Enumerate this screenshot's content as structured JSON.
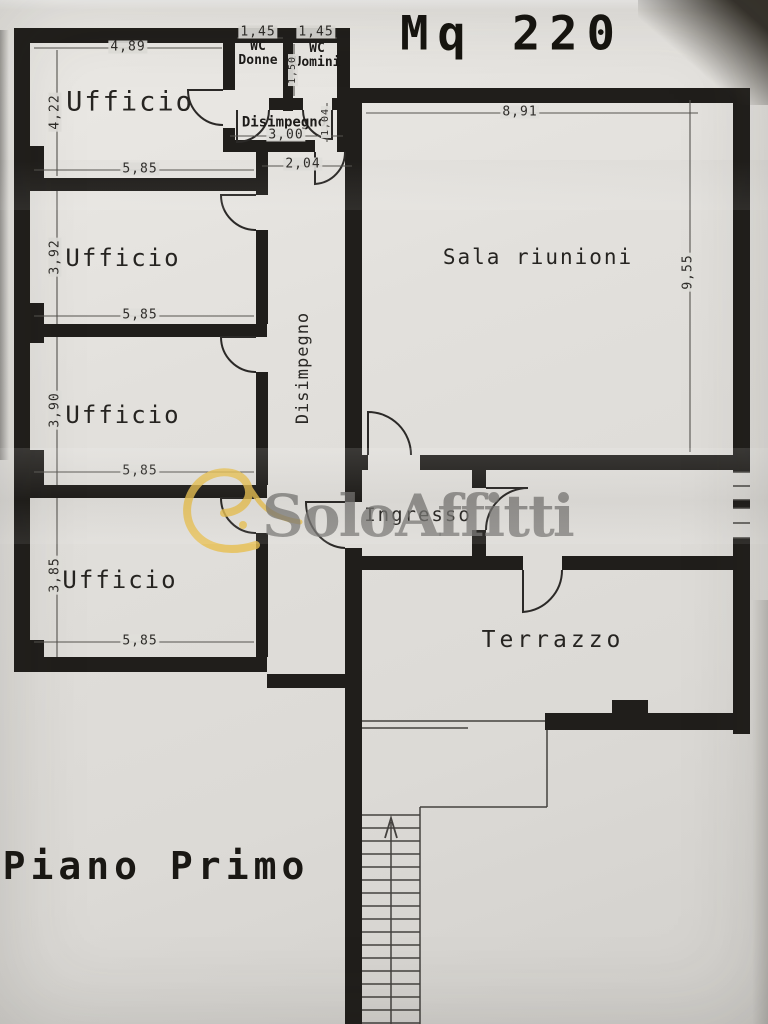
{
  "page": {
    "title": "Mq 220",
    "floor": "Piano Primo"
  },
  "watermark": {
    "text": "SoloAffitti",
    "logo_icon": "gold-leaf-swoosh",
    "text_color": "#767471",
    "swoosh_color": "#e8c050"
  },
  "rooms": {
    "ufficio1": "Ufficio",
    "ufficio2": "Ufficio",
    "ufficio3": "Ufficio",
    "ufficio4": "Ufficio",
    "wc_donne": {
      "line1": "WC",
      "line2": "Donne"
    },
    "wc_uomini": {
      "line1": "WC",
      "line2": "Uomini"
    },
    "disimpegno_hall": "Disimpegno",
    "disimpegno_corridor": "Disimpegno",
    "sala_riunioni": "Sala riunioni",
    "ingresso": "Ingresso",
    "terrazzo": "Terrazzo"
  },
  "dimensions": {
    "ufficio1_width_top": "4,89",
    "ufficio1_height": "4,22",
    "ufficio1_width_bottom": "5,85",
    "wc_donne_width": "1,45",
    "wc_uomini_width": "1,45",
    "wc_depth": "1,50",
    "hall_width": "3,00",
    "hall_door": "1,04",
    "corridor_top_width": "2,04",
    "sala_width_top": "8,91",
    "sala_height_right": "9,55",
    "ufficio2_height": "3,92",
    "ufficio2_width_bottom": "5,85",
    "ufficio3_height": "3,90",
    "ufficio3_width_bottom": "5,85",
    "ufficio4_height": "3,85",
    "ufficio4_width_bottom": "5,85"
  },
  "stairs": {
    "direction_icon": "arrow-up"
  }
}
